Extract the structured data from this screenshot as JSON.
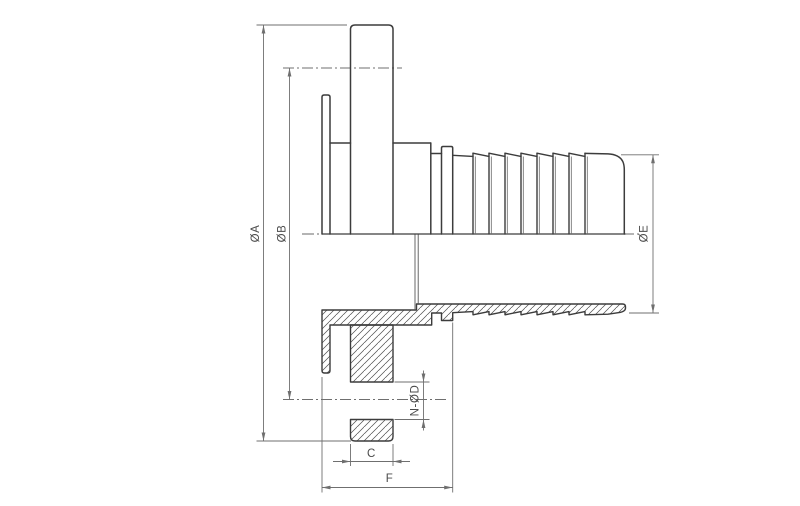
{
  "drawing": {
    "type": "technical-drawing",
    "view": "half-section side view of a flanged hose tail (barb) fitting",
    "dimension_labels": {
      "flange_outer_diameter": "ØA",
      "bolt_circle_diameter": "ØB",
      "hose_tail_diameter": "ØE",
      "bolt_holes": "N-ØD",
      "flange_thickness": "C",
      "neck_length": "F"
    },
    "colors": {
      "background": "#ffffff",
      "outline": "#3c3c3c",
      "dimension_line": "#6f6f6f",
      "hatch": "#4e4e4e",
      "label_text": "#4a4a4a"
    }
  }
}
